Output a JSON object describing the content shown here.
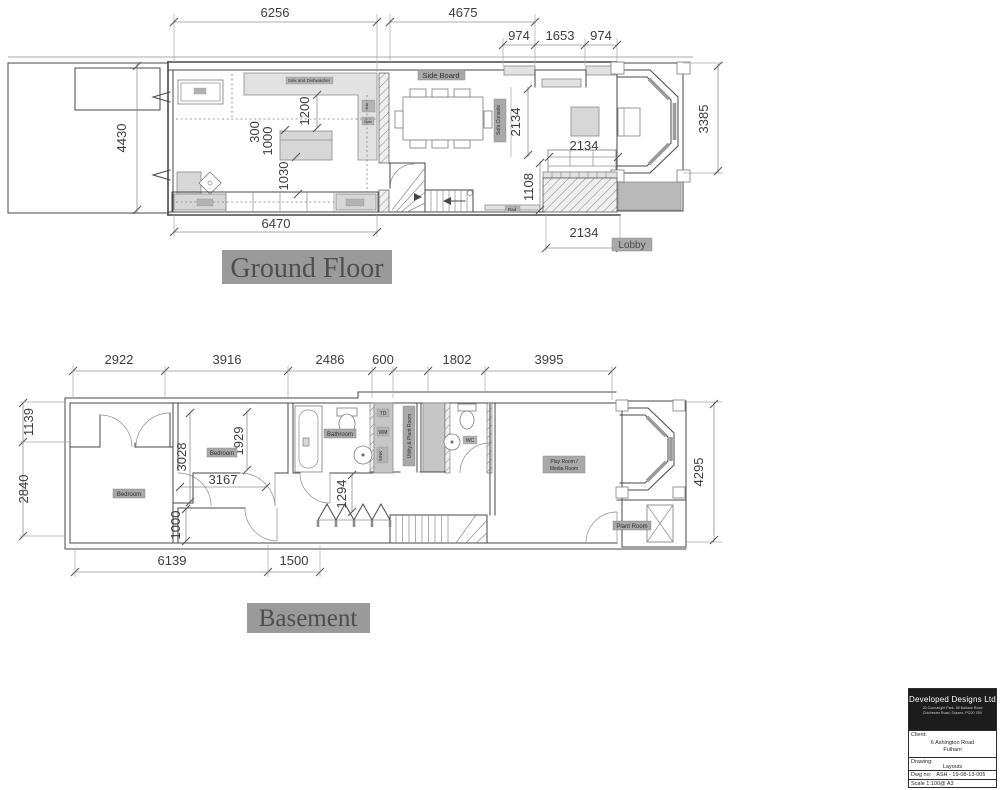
{
  "ground_floor": {
    "title": "Ground Floor",
    "dims": {
      "w6256": "6256",
      "w4675": "4675",
      "bay_left": "974",
      "bay_mid": "1653",
      "bay_right": "974",
      "garden_depth": "4430",
      "kitchen_width": "6470",
      "gap300": "300",
      "island1000": "1000",
      "clear1030": "1030",
      "clear1200": "1200",
      "console2134": "2134",
      "sofa2134": "2134",
      "terrace1108": "1108",
      "terrace2134": "2134",
      "bay_depth": "3385"
    },
    "labels": {
      "side_board": "Side Board",
      "sofa_console": "Sofa Console",
      "worktop_note": "Sink and Dishwasher",
      "hob": "Hob",
      "oven": "Oven",
      "rad": "Rad",
      "lobby": "Lobby"
    }
  },
  "basement": {
    "title": "Basement",
    "dims": {
      "seg2922": "2922",
      "seg3916": "3916",
      "seg2486": "2486",
      "seg600": "600",
      "seg1802": "1802",
      "seg3995": "3995",
      "left1139": "1139",
      "left2840": "2840",
      "d3028": "3028",
      "d1929": "1929",
      "d3167": "3167",
      "d1000": "1000",
      "d1294": "1294",
      "bottom6139": "6139",
      "bottom1500": "1500",
      "right4295": "4295"
    },
    "labels": {
      "bedroom_left": "Bedroom",
      "bedroom_mid": "Bedroom",
      "bathroom": "Bathroom",
      "td": "TD",
      "wm": "WM",
      "sink": "SINK",
      "utility": "Utility & Plant Room",
      "wc": "WC",
      "playroom_line1": "Play Room /",
      "playroom_line2": "Media Room",
      "plantroom": "Plant Room"
    }
  },
  "title_block": {
    "company": "Developed Designs Ltd",
    "address_line1": "30 Connaught Park, 98 Balham Road",
    "address_line2": "Chichester Road, Sussex, PO20 7BV",
    "client_label": "Client:",
    "client_line1": "6 Ashington Road",
    "client_line2": "Fulham",
    "drawing_label": "Drawing:",
    "drawing_value": "Layouts",
    "dwg_no_label": "Dwg no:",
    "dwg_no_value": "ASH - 19-08-13-005",
    "scale": "Scale 1:100@ A3"
  }
}
